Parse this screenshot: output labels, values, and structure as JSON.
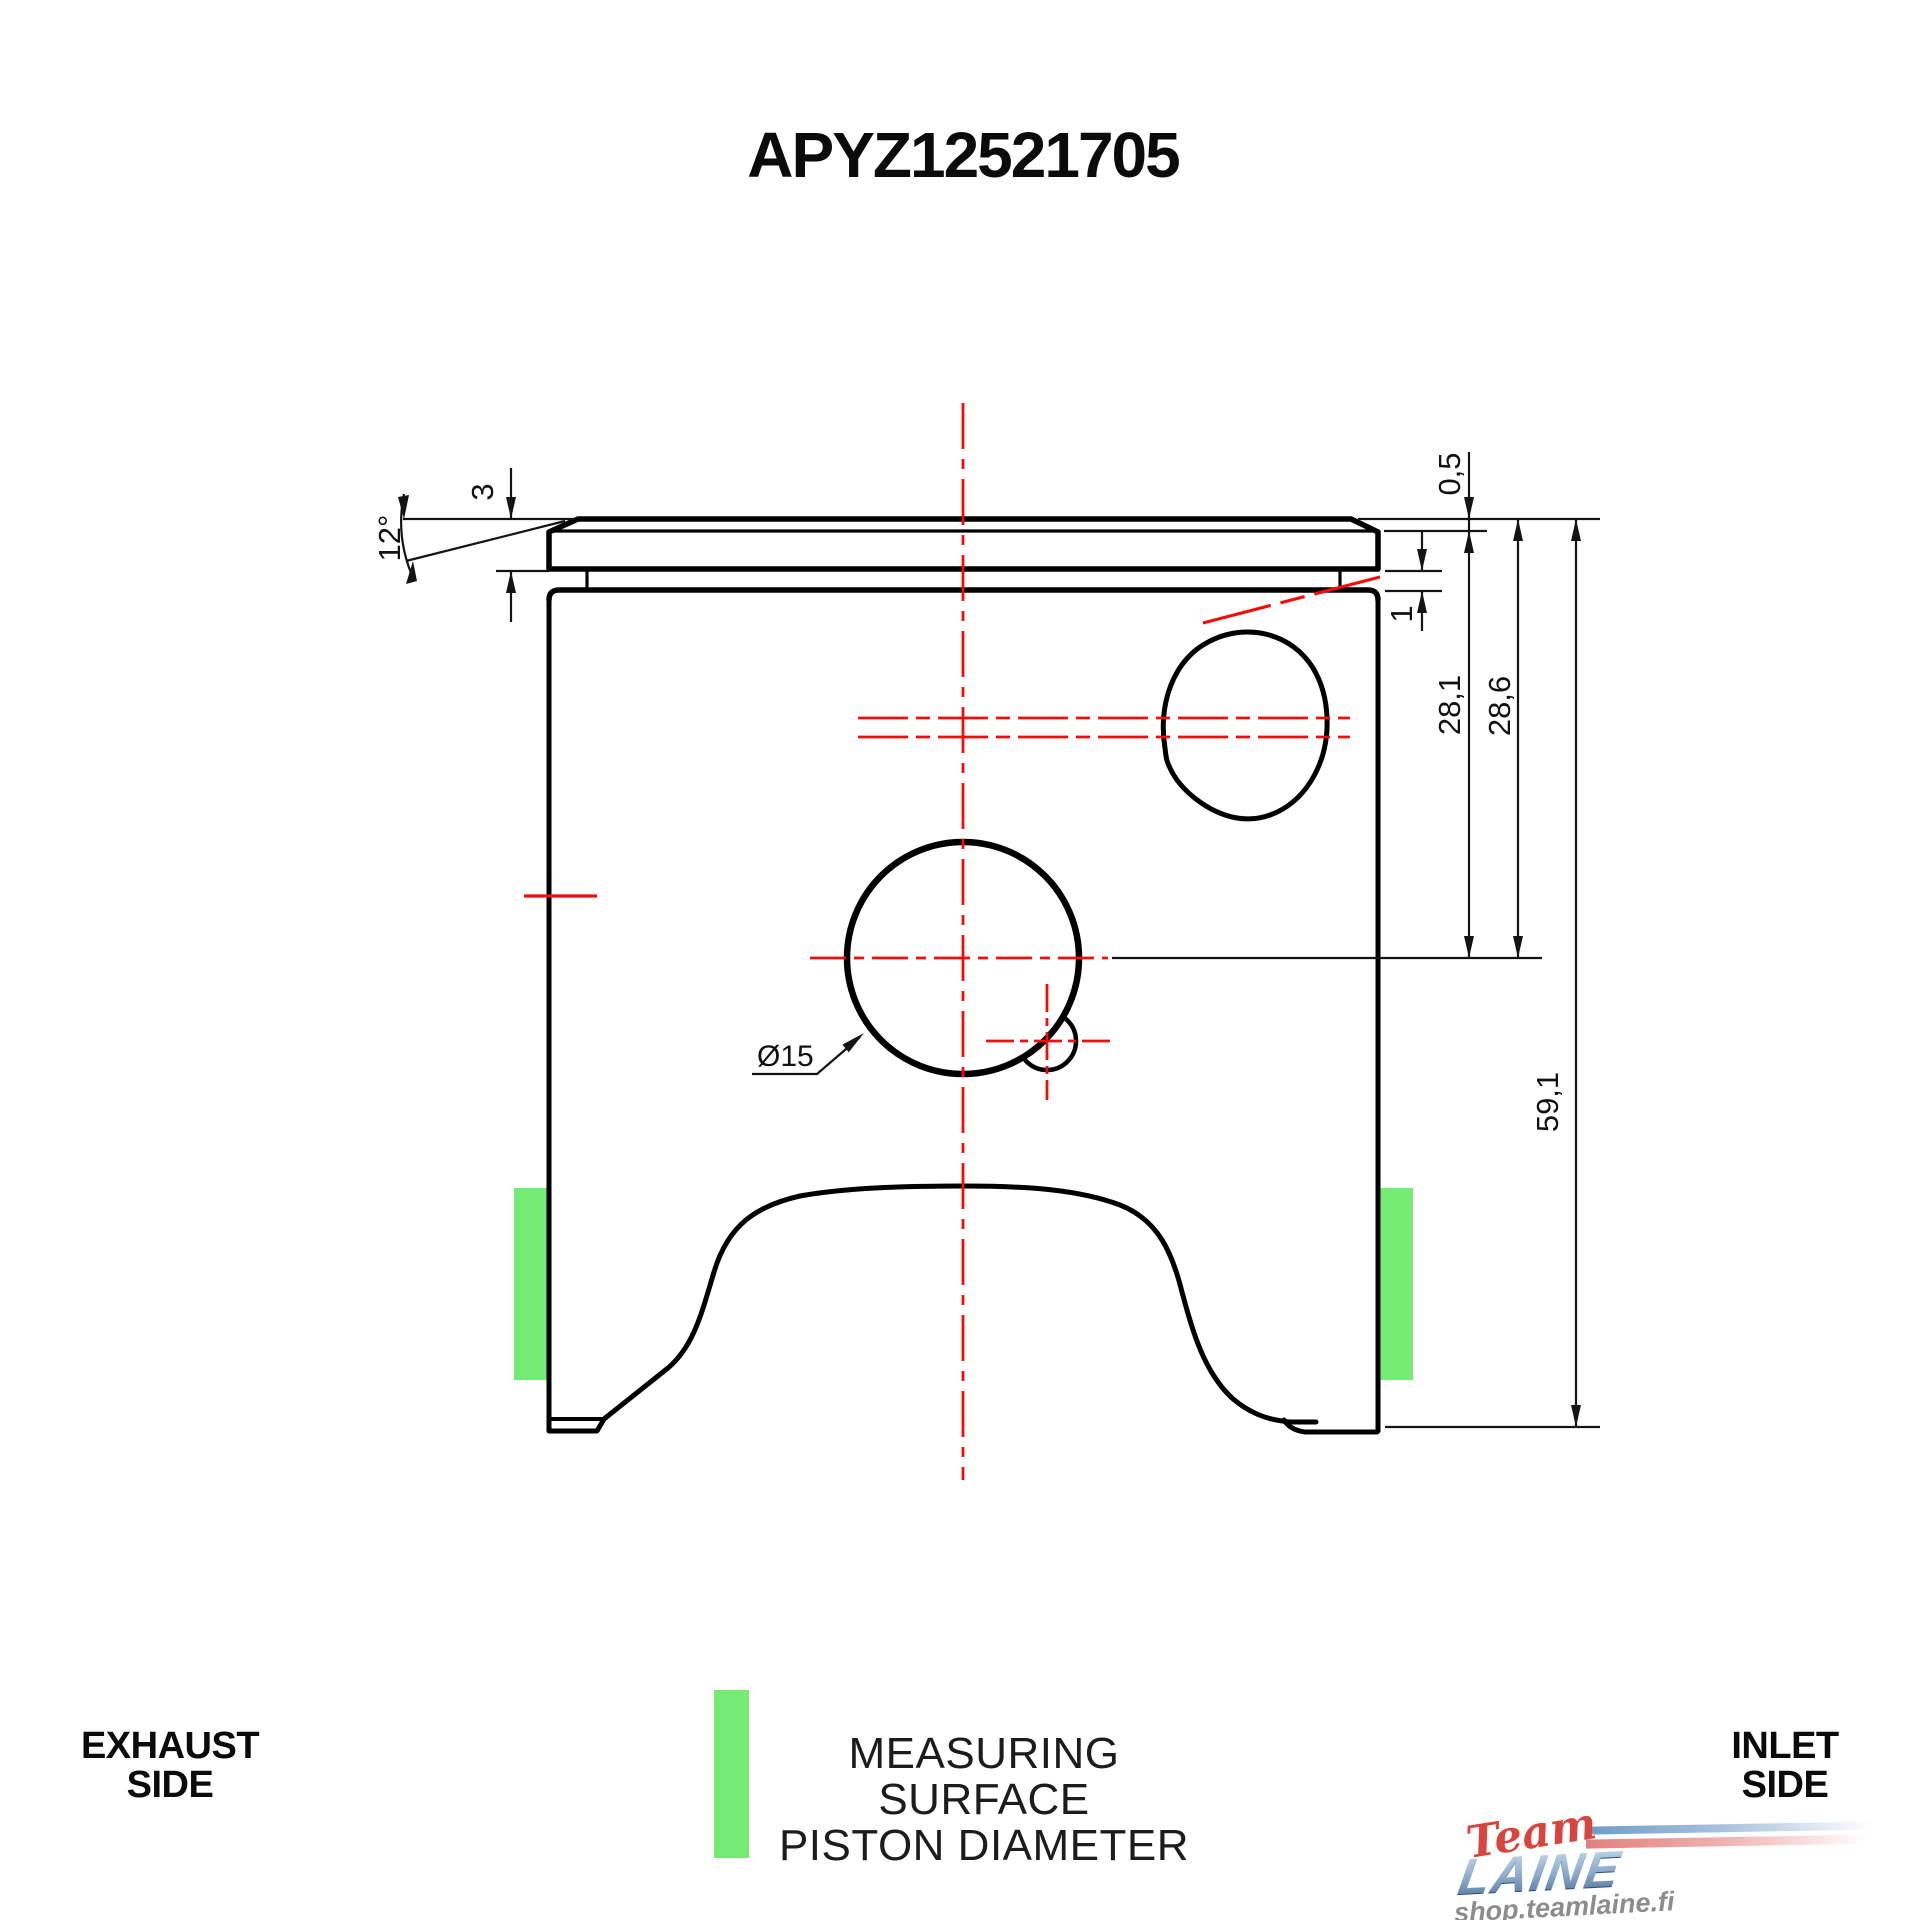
{
  "title": "APYZ12521705",
  "colors": {
    "outline": "#000000",
    "centerline_red": "#f20d0d",
    "measuring_surface_green": "#74ec74"
  },
  "dimensions": {
    "crown_taper_angle": "12°",
    "top_land_height": "3",
    "crown_edge_step": "0,5",
    "ring_groove_width": "1",
    "top_to_pin_center_min": "28,1",
    "top_to_pin_center_max": "28,6",
    "total_length": "59,1",
    "pin_bore_diameter": "Ø15"
  },
  "legend": {
    "left": {
      "line1": "EXHAUST",
      "line2": "SIDE"
    },
    "center": {
      "line1": "MEASURING SURFACE",
      "line2": "PISTON DIAMETER"
    },
    "right": {
      "line1": "INLET",
      "line2": "SIDE"
    }
  },
  "logo": {
    "script": "Team",
    "name": "LAINE",
    "url": "shop.teamlaine.fi"
  }
}
